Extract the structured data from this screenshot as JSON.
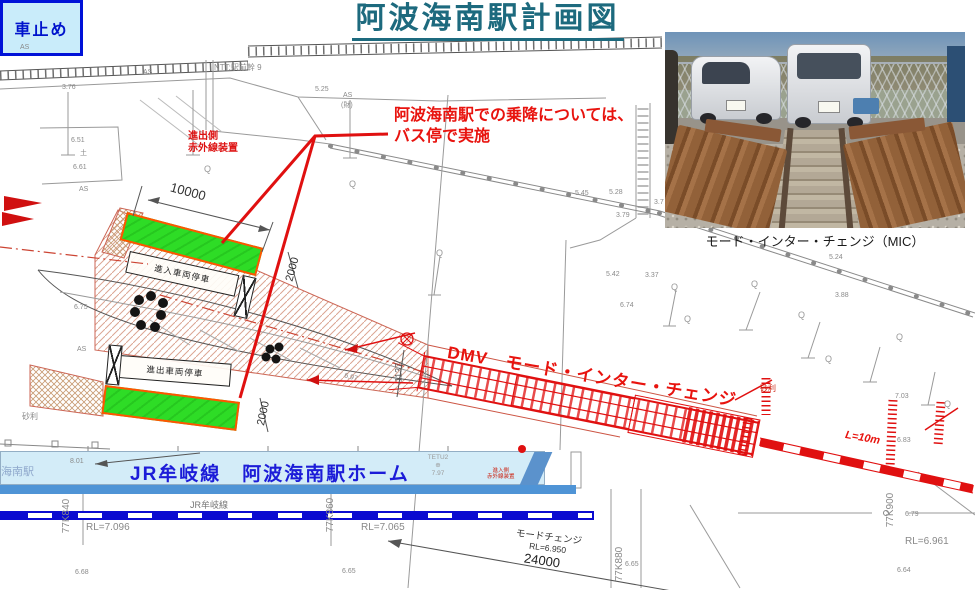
{
  "title": "阿波海南駅計画図",
  "photo": {
    "caption": "モード・インター・チェンジ（MIC）"
  },
  "notes": {
    "boarding_line1": "阿波海南駅での乗降については、",
    "boarding_line2": "バス停で実施"
  },
  "labels": {
    "dmv": "DMV　モード・インター・チェンジ",
    "infrared_out1": "進出側",
    "infrared_out2": "赤外線装置",
    "infrared_in1": "進入側",
    "infrared_in2": "赤外線装置",
    "parking_in": "進入車両停車",
    "parking_out": "進出車両停車",
    "car_stop": "車止め",
    "mode_change": "モードチェンジ",
    "mode_change_rl": "RL=6.950",
    "l10m": "L=10m"
  },
  "platform": {
    "name": "JR牟岐線　阿波海南駅ホーム",
    "left_edge": "海南駅",
    "tetu_1": "TETU2",
    "tetu_2": "⊕",
    "tetu_3": "7.97"
  },
  "track": {
    "jr_line": "JR牟岐線",
    "rl_a": "RL=7.096",
    "rl_b": "RL=7.065",
    "rl_c": "RL=6.961",
    "km_a": "77K840",
    "km_b": "77K860",
    "km_c": "77K880",
    "km_d": "77K900"
  },
  "dims": {
    "d10000": "10000",
    "d2000a": "2000",
    "d2000b": "2000",
    "d1137": "1137",
    "d24000": "24000"
  },
  "colors": {
    "accent_red": "#e01010",
    "title_teal": "#1d6a7e",
    "bus_green": "#2edc26",
    "platform_blue": "#d3ecf8",
    "rail_blue": "#0a0ad0",
    "text_blue": "#1c1cd8"
  },
  "spots": [
    {
      "t": "AS",
      "x": 20,
      "y": 44
    },
    {
      "t": "AS",
      "x": 143,
      "y": 69
    },
    {
      "t": "3.76",
      "x": 62,
      "y": 84
    },
    {
      "t": "NTT:駅前幹 9",
      "x": 214,
      "y": 64,
      "c": "s8"
    },
    {
      "t": "5.25",
      "x": 315,
      "y": 86
    },
    {
      "t": "AS",
      "x": 343,
      "y": 92
    },
    {
      "t": "(財)",
      "x": 341,
      "y": 102
    },
    {
      "t": "6.51",
      "x": 71,
      "y": 137
    },
    {
      "t": "土",
      "x": 80,
      "y": 150
    },
    {
      "t": "6.61",
      "x": 73,
      "y": 164
    },
    {
      "t": "AS",
      "x": 79,
      "y": 186
    },
    {
      "t": "6.75",
      "x": 74,
      "y": 304
    },
    {
      "t": "AS",
      "x": 77,
      "y": 346
    },
    {
      "t": "砂利",
      "x": 22,
      "y": 413,
      "c": "s8"
    },
    {
      "t": "5.45",
      "x": 575,
      "y": 190
    },
    {
      "t": "5.28",
      "x": 609,
      "y": 189
    },
    {
      "t": "3.79",
      "x": 616,
      "y": 212
    },
    {
      "t": "3.7",
      "x": 654,
      "y": 199
    },
    {
      "t": "5.42",
      "x": 606,
      "y": 271
    },
    {
      "t": "3.37",
      "x": 645,
      "y": 272
    },
    {
      "t": "6.74",
      "x": 620,
      "y": 302
    },
    {
      "t": "5.24",
      "x": 829,
      "y": 254
    },
    {
      "t": "3.88",
      "x": 835,
      "y": 292
    },
    {
      "t": "7.03",
      "x": 895,
      "y": 393
    },
    {
      "t": "6.83",
      "x": 897,
      "y": 437
    },
    {
      "t": "6.79",
      "x": 905,
      "y": 511
    },
    {
      "t": "6.64",
      "x": 897,
      "y": 567
    },
    {
      "t": "6.68",
      "x": 75,
      "y": 569
    },
    {
      "t": "6.65",
      "x": 342,
      "y": 568
    },
    {
      "t": "6.65",
      "x": 625,
      "y": 561
    },
    {
      "t": "8.01",
      "x": 70,
      "y": 458
    },
    {
      "t": "6.97",
      "x": 344,
      "y": 374,
      "r": 15
    },
    {
      "t": "砂利",
      "x": 760,
      "y": 385,
      "c": "red"
    },
    {
      "t": "Q",
      "x": 204,
      "y": 165,
      "c": "q"
    },
    {
      "t": "Q",
      "x": 349,
      "y": 180,
      "c": "q"
    },
    {
      "t": "Q",
      "x": 436,
      "y": 249,
      "c": "q"
    },
    {
      "t": "Q",
      "x": 671,
      "y": 283,
      "c": "q"
    },
    {
      "t": "Q",
      "x": 684,
      "y": 315,
      "c": "q"
    },
    {
      "t": "Q",
      "x": 751,
      "y": 280,
      "c": "q"
    },
    {
      "t": "Q",
      "x": 798,
      "y": 311,
      "c": "q"
    },
    {
      "t": "Q",
      "x": 825,
      "y": 355,
      "c": "q"
    },
    {
      "t": "Q",
      "x": 896,
      "y": 333,
      "c": "q"
    },
    {
      "t": "Q",
      "x": 944,
      "y": 400,
      "c": "q"
    }
  ]
}
